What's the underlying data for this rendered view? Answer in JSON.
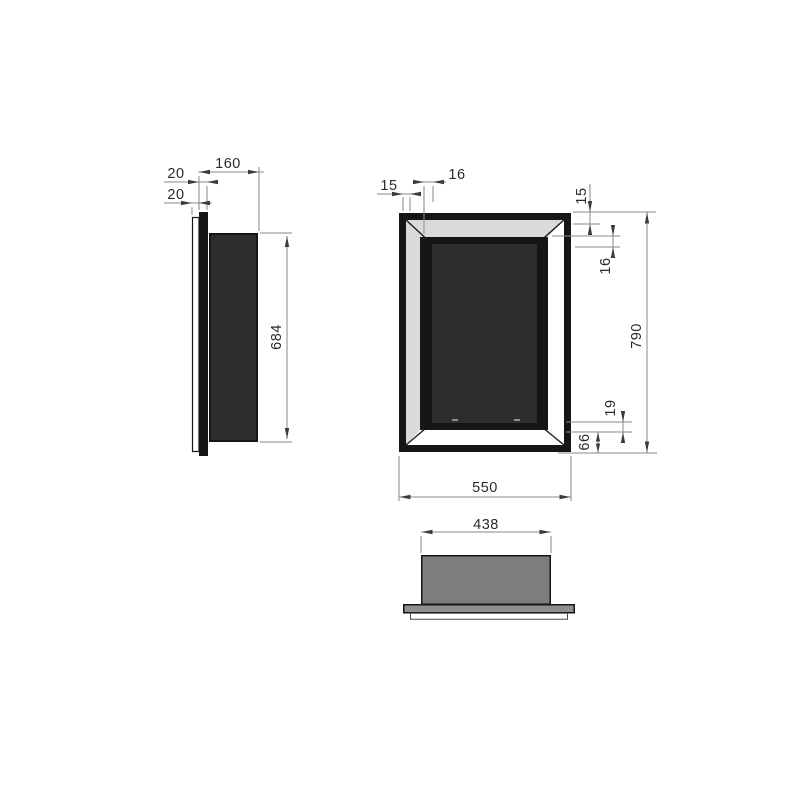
{
  "drawing": {
    "type": "technical-drawing",
    "views": {
      "side": {
        "label": "side view",
        "dims": {
          "depth": "160",
          "flange": "20",
          "plate": "20",
          "body_height": "684"
        }
      },
      "front": {
        "label": "front view",
        "dims": {
          "frame_face_left": "15",
          "bevel_left": "16",
          "frame_face_top": "15",
          "bevel_top": "16",
          "overall_height": "790",
          "slot_offset": "19",
          "bottom_margin": "66",
          "overall_width": "550"
        }
      },
      "bottom": {
        "label": "bottom view",
        "dims": {
          "body_width": "438"
        }
      }
    },
    "colors": {
      "outline": "#161616",
      "dark_fill": "#2d2d2d",
      "bevel_gray": "#dadada",
      "body_gray": "#7d7d7d",
      "plate_gray": "#8f8f8f",
      "dim_line": "#8a8a8a",
      "arrow": "#3c3c3c",
      "label_text": "#2b2b2b",
      "background": "#ffffff"
    }
  }
}
